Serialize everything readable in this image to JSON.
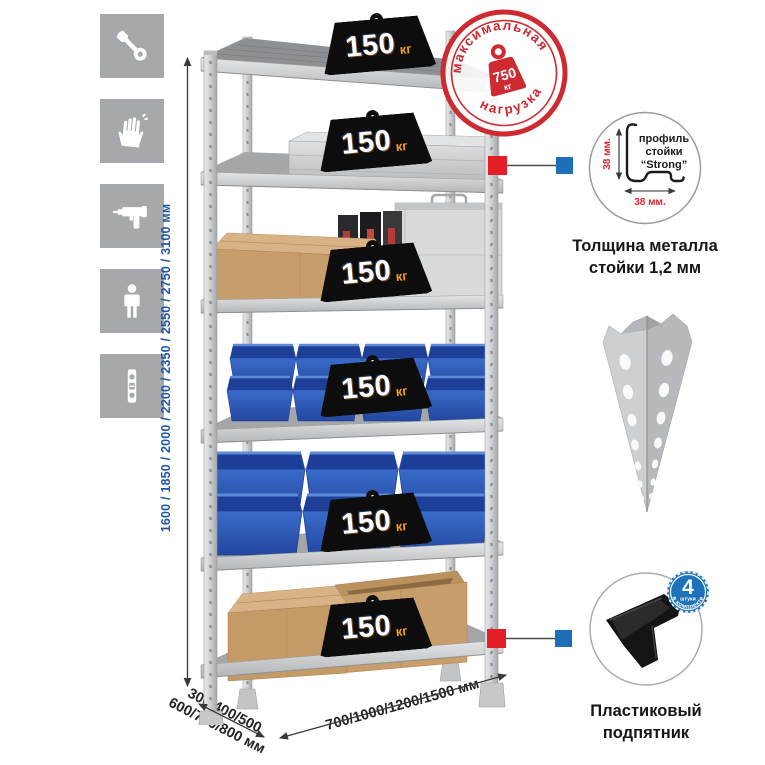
{
  "sidebar": {
    "icons": [
      {
        "name": "wrench"
      },
      {
        "name": "gloves"
      },
      {
        "name": "drill"
      },
      {
        "name": "person"
      },
      {
        "name": "level"
      }
    ]
  },
  "dimensions": {
    "height": "1600 / 1850 / 2000 / 2200 / 2350 / 2550 / 2750 / 3100 мм",
    "depth_line1": "300/400/500",
    "depth_line2": "600/700/800 мм",
    "width": "700/1000/1200/1500 мм"
  },
  "shelf_loads": [
    {
      "value": "150",
      "unit": "кг"
    },
    {
      "value": "150",
      "unit": "кг"
    },
    {
      "value": "150",
      "unit": "кг"
    },
    {
      "value": "150",
      "unit": "кг"
    },
    {
      "value": "150",
      "unit": "кг"
    },
    {
      "value": "150",
      "unit": "кг"
    }
  ],
  "max_load_stamp": {
    "arc_top": "максимальная",
    "arc_bottom": "нагрузка",
    "value": "750",
    "unit": "кг"
  },
  "profile_callout": {
    "label_line1": "профиль",
    "label_line2": "стойки",
    "label_line3": "“Strong”",
    "dim_vertical": "38 мм.",
    "dim_horizontal": "38 мм.",
    "caption_line1": "Толщина металла",
    "caption_line2": "стойки 1,2 мм"
  },
  "foot_callout": {
    "badge_value": "4",
    "badge_unit": "штуки",
    "badge_arc": "в комплекте",
    "caption_line1": "Пластиковый",
    "caption_line2": "подпятник"
  },
  "colors": {
    "accent_red": "#cd2a31",
    "accent_blue": "#1d70b7",
    "dimension_text_blue": "#2058a8",
    "icon_tile_gray": "#a6a8ab",
    "weight_black": "#0d0d0d",
    "weight_unit_orange": "#f79b1e",
    "bin_blue": "#2d5fc0",
    "cardboard_tan": "#c69d6b"
  }
}
